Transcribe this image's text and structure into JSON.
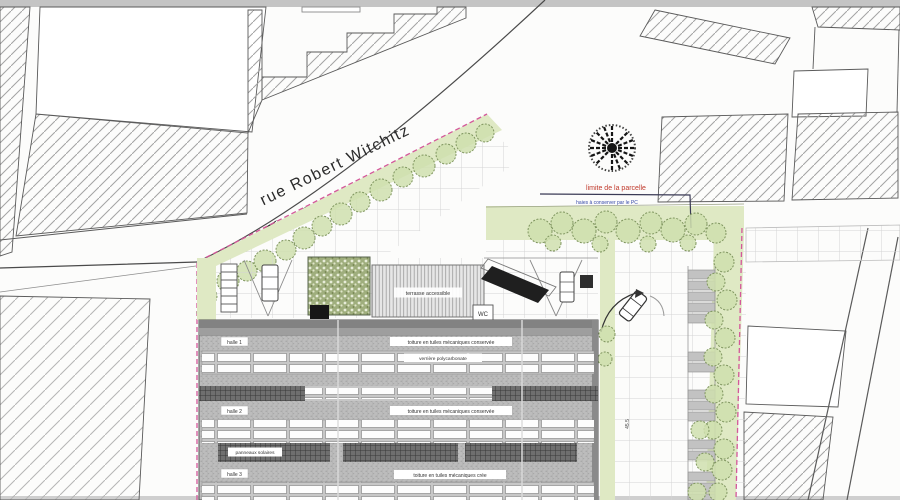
{
  "street": {
    "label": "rue Robert Witchitz"
  },
  "parcel": {
    "boundary_label": "limite de la parcelle",
    "hedge_note": "haies à conserver par le PC"
  },
  "building": {
    "terrace_label": "terrasse accessible",
    "wc_label": "WC",
    "skylight_label": "verrière polycarbonate",
    "panels_label": "panneaux solaires",
    "halls": [
      {
        "name": "halle 1",
        "roof_label": "toiture en tuiles mécaniques conservée"
      },
      {
        "name": "halle 2",
        "roof_label": "toiture en tuiles mécaniques conservée"
      },
      {
        "name": "halle 3",
        "roof_label": "toiture en tuiles mécaniques crée"
      }
    ]
  },
  "dimensions": {
    "aisle": "45.5"
  },
  "colors": {
    "boundary_pink": "#d4579a",
    "limit_red": "#c0392b",
    "note_blue": "#3548a8",
    "green_light": "#dfe9c4",
    "tree_stroke": "#7f955f"
  }
}
